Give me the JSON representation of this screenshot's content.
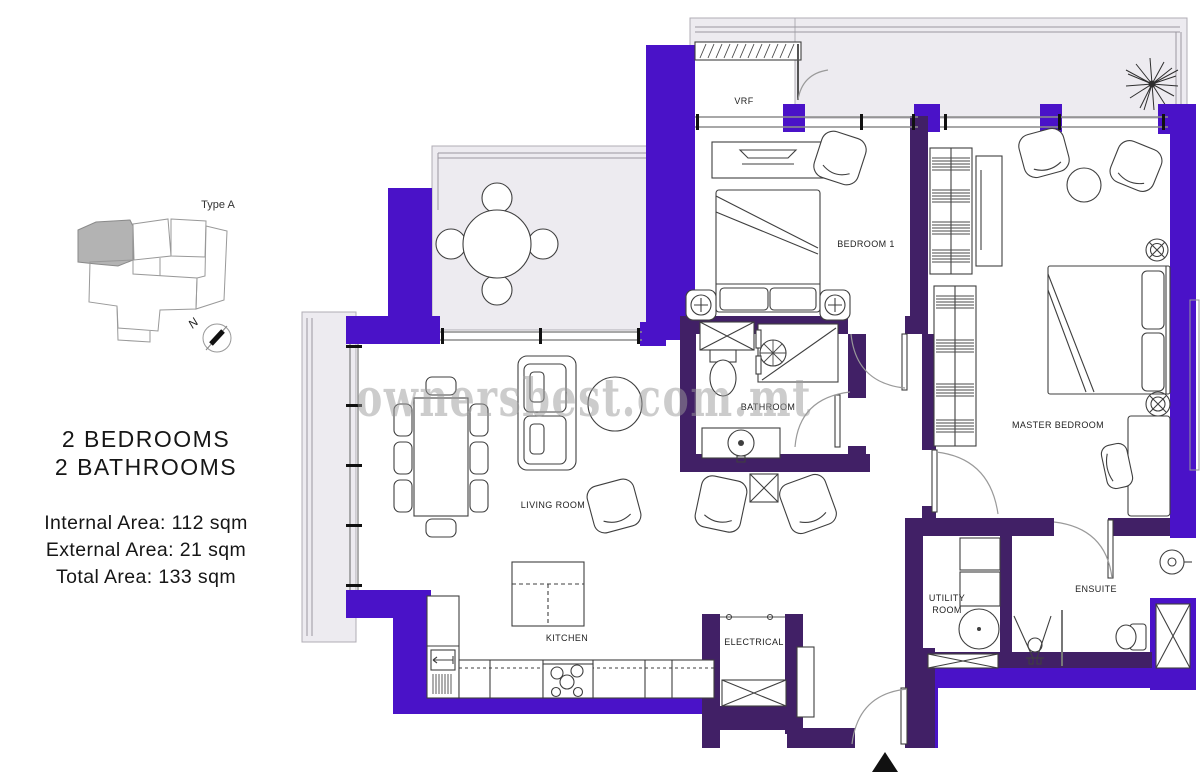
{
  "title": "Apartment floor plan - Type A",
  "watermark": "ownersbest.com.mt",
  "key_plan": {
    "label": "Type A",
    "north": "N"
  },
  "summary": {
    "line1": "2 BEDROOMS",
    "line2": "2 BATHROOMS",
    "internal": "Internal Area: 112 sqm",
    "external": "External Area: 21 sqm",
    "total": "Total Area: 133 sqm"
  },
  "rooms": {
    "vrf": "VRF",
    "bedroom1": "BEDROOM 1",
    "bathroom": "BATHROOM",
    "master_bedroom": "MASTER BEDROOM",
    "living_room": "LIVING ROOM",
    "kitchen": "KITCHEN",
    "electrical": "ELECTRICAL",
    "utility_room_line1": "UTILITY",
    "utility_room_line2": "ROOM",
    "ensuite": "ENSUITE"
  },
  "colors": {
    "wall_exterior": "#4a12c8",
    "wall_interior": "#412066",
    "terrace_fill": "#edebf0",
    "terrace_line": "#9a97a0",
    "watermark": "#9b9b9b",
    "keyplan_unit_fill": "#b3b3b3"
  }
}
